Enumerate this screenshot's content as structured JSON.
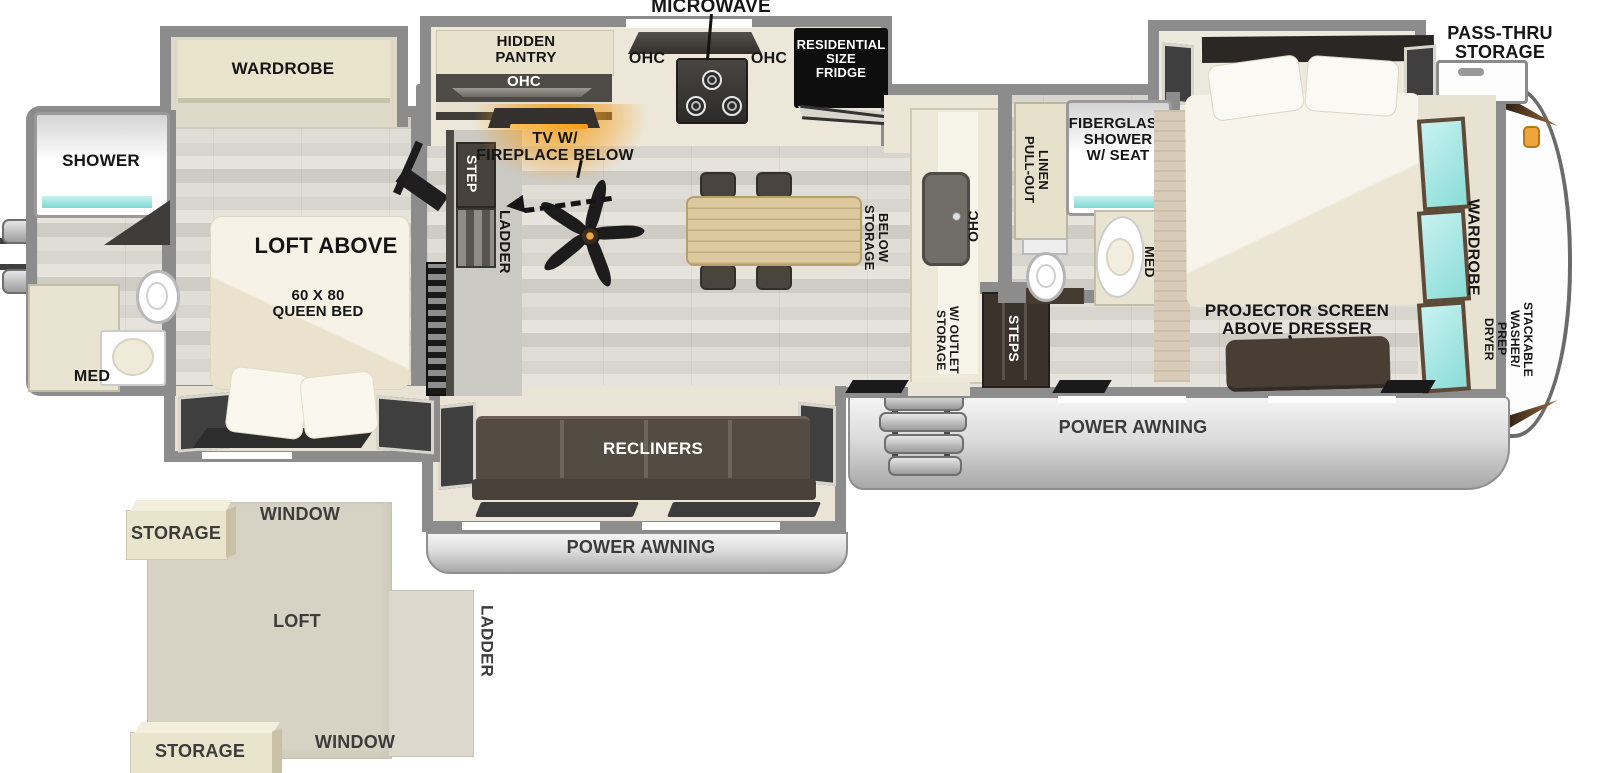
{
  "colors": {
    "wall": "#8c8c8c",
    "floor": "#dcd8d2",
    "cabinet_cream": "#ece6d7",
    "dark_wood": "#4a423a",
    "label_black": "#151515",
    "teal_accent": "#7fd9d2",
    "orange_accent": "#f5a223",
    "awning_text": "#3b3b3b"
  },
  "labels": {
    "microwave": "MICROWAVE",
    "hidden_pantry": "HIDDEN\nPANTRY",
    "ohc_pantry": "OHC",
    "ohc_left": "OHC",
    "ohc_right": "OHC",
    "fridge": "RESIDENTIAL\nSIZE\nFRIDGE",
    "pass_thru_storage": "PASS-THRU\nSTORAGE",
    "wardrobe_rear": "WARDROBE",
    "shower_rear": "SHOWER",
    "med_rear": "MED",
    "loft_above": "LOFT ABOVE",
    "queen_bed": "60 X 80\nQUEEN BED",
    "tv_fireplace": "TV W/\nFIREPLACE BELOW",
    "step": "STEP",
    "ladder": "LADDER",
    "storage_below": "STORAGE\nBELOW",
    "ohc_island": "OHC",
    "pull_out_linen": "PULL-OUT\nLINEN",
    "fiberglass_shower": "FIBERGLASS\nSHOWER\nW/ SEAT",
    "med_mid": "MED",
    "storage_outlet": "STORAGE\nW/ OUTLET",
    "steps": "STEPS",
    "projector_screen": "PROJECTOR SCREEN\nABOVE DRESSER",
    "wardrobe_front": "WARDROBE",
    "stackable_washer": "STACKABLE\nWASHER/",
    "dryer_prep": "DRYER\nPREP",
    "recliners": "RECLINERS",
    "power_awning_door": "POWER AWNING",
    "power_awning_living": "POWER AWNING"
  },
  "loft_inset": {
    "storage_top": "STORAGE",
    "window_top": "WINDOW",
    "loft": "LOFT",
    "ladder": "LADDER",
    "window_bottom": "WINDOW",
    "storage_bottom": "STORAGE"
  }
}
